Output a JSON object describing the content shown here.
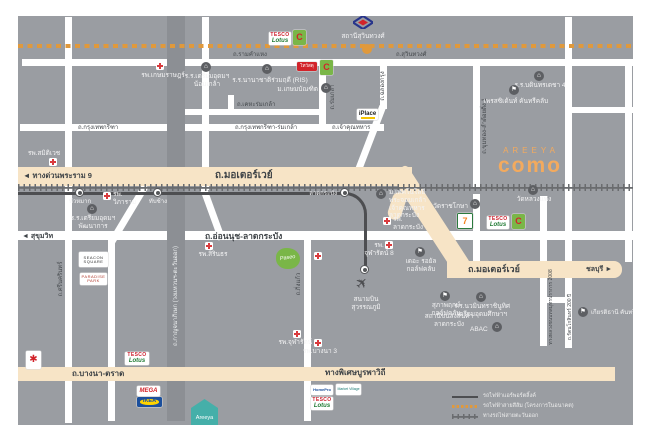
{
  "brand": {
    "areeya": "AREEYA",
    "como": "como"
  },
  "legend": {
    "airport_link": "รถไฟฟ้าแอร์พอร์ตลิ้งค์",
    "orange_line": "รถไฟฟ้าสายสีส้ม (โครงการในอนาคต)",
    "east_rail": "ทางรถไฟสายตะวันออก"
  },
  "roads": {
    "ramkhamhaeng": "ถ.รามคำแหง",
    "suwinthawong": "ถ.สุวินทวงศ์",
    "krungthep_kreetha": "ถ.กรุงเทพกรีฑา",
    "krungthep_kreetha_romklao": "ถ.กรุงเทพกรีฑา-ร่มเกล้า",
    "kheha_romklao": "ถ.เคหะร่มเกล้า",
    "chaokhun_thahan": "ถ.เจ้าคุณทหาร",
    "rama9": "◄ ทางด่วนพระราม 9",
    "motorway": "ถ.มอเตอร์เวย์",
    "motorway2": "ถ.มอเตอร์เวย์",
    "chonburi": "ชลบุรี ►",
    "sukhumvit": "◄ สุขุมวิท",
    "onnut": "ถ.อ่อนนุช-ลาดกระบัง",
    "bangna_trad": "ถ.บางนา-ตราด",
    "burapha": "ทางพิเศษบูรพาวิถี",
    "srinakarin": "ถ.ศรีนครินทร์",
    "kanchanaphisek": "ถ.กาญจนาภิเษก (วงแหวนฯ-ตะวันออก)",
    "romklao": "ถ.ร่มเกล้า",
    "chalongkrung": "ถ.ฉลองกรุง",
    "khumthong": "ถ.ขุมทอง-ลำต้อยติ่ง 1",
    "kingkaew": "ถ.กิ่งแก้ว",
    "rural2008": "ทางหลวงชนบทสมุทรปราการ 2008",
    "rattanakosin200": "ถ.รัตนโกสินทร์ 200 ปี"
  },
  "stations": {
    "suwinthawong": "สถานีสุวินทวงศ์",
    "huamak": "หัวหมาก",
    "thapchang": "ทับช้าง",
    "latkrabang": "ลาดกระบัง",
    "suvarnabhumi": "สนามบิน\nสุวรรณภูมิ"
  },
  "places": {
    "kasemrad": "รพ.เกษมราษฎร์",
    "samitivej": "รพ.สมิติเวช",
    "vibharam": "รพ.\nวิภาราม",
    "sirindhorn": "รพ.สิรินธร",
    "chularat8": "รพ.\nจุฬารัตน์ 8",
    "chularat9": "รพ.จุฬารัตน์ 9",
    "bangna3": "รพ.บางนา 3",
    "latkrabang_hospital": "รพ.\nลาดกระบัง",
    "triamudom_nomklao": "ร.ร.เตรียมอุดมฯ\nน้อมเกล้า",
    "ris": "ร.ร.นานาชาติร่วมฤดี (RIS)",
    "kasembundit": "ม.เกษมบัณฑิต",
    "triamudom_pattanakarn": "ร.ร.เตรียมอุดมฯ\nพัฒนาการ",
    "bodindecha": "ร.ร.บดินทรเดชา 4",
    "president_cc": "เพรสซิเด้นท์ คันทรีคลับ",
    "kmitl": "ม.เทคโนโลยี\nพระจอมเกล้า\nเจ้าคุณทหาร\nลาดกระบัง",
    "wat_ratchakosa": "วัดราชโกษา",
    "wat_luangphaeng": "วัดหลวงแพ่ง",
    "royal_golf": "เดอะ รอยัล\nกอล์ฟคลับ",
    "supapruek_golf": "สุภาพฤกษ์\nกอล์ฟคลับ",
    "nawamin": "ร.ร.นวมินทราชินูทิศ\nเตรียมอุดมศึกษาฯ",
    "abac": "ABAC",
    "icd": "สถานีขนส่งสินค้า\nลาดกระบัง",
    "kiarti_thanee": "เกียรติธานี คันทรีคลับ"
  },
  "logos": {
    "tesco_line1": "TESCO",
    "tesco_line2": "Lotus",
    "bigc": "C",
    "bigc_star": "✱",
    "thaiwatsadu": "ไทวัสดุ",
    "iplace": "iPlace",
    "seven": "7",
    "seacon": "SEACON\nSQUARE",
    "paradise": "PARADISE\nPARK",
    "paseo": "Paseo",
    "mega": "MEGA",
    "ikea": "IKEA",
    "homepro": "HomePro",
    "market_village": "Market Village",
    "areeya_house": "Areeya"
  },
  "colors": {
    "background": "#9a9da2",
    "highway": "#f7e4c6",
    "accent_orange": "#e0993c",
    "brand_orange": "#f3aa5e",
    "rail_dark": "#4d4e51",
    "hospital_red": "#d93a3d"
  }
}
